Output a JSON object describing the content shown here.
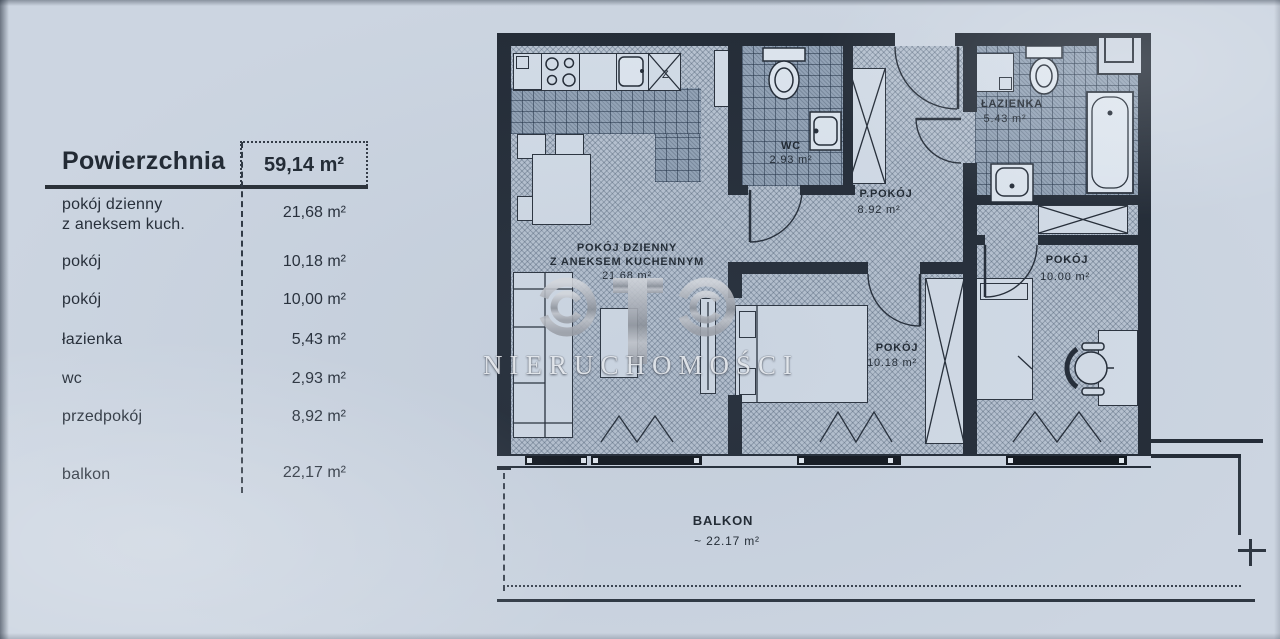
{
  "area_table": {
    "header_label": "Powierzchnia",
    "header_value": "59,14 m²",
    "rows": [
      {
        "label": "pokój dzienny",
        "label2": "z aneksem kuch.",
        "value": "21,68 m²"
      },
      {
        "label": "pokój",
        "label2": "",
        "value": "10,18 m²"
      },
      {
        "label": "pokój",
        "label2": "",
        "value": "10,00 m²"
      },
      {
        "label": "łazienka",
        "label2": "",
        "value": "5,43 m²"
      },
      {
        "label": "wc",
        "label2": "",
        "value": "2,93 m²"
      },
      {
        "label": "przedpokój",
        "label2": "",
        "value": "8,92 m²"
      },
      {
        "label": "balkon",
        "label2": "",
        "value": "22,17 m²"
      }
    ]
  },
  "floor_plan": {
    "living_room": {
      "name": "POKÓJ DZIENNY",
      "name2": "Z ANEKSEM KUCHENNYM",
      "area": "21.68 m²"
    },
    "wc": {
      "name": "WC",
      "area": "2.93 m²"
    },
    "hall": {
      "name": "P.POKÓJ",
      "area": "8.92 m²"
    },
    "bathroom": {
      "name": "ŁAZIENKA",
      "area": "5.43 m²"
    },
    "bedroom": {
      "name": "POKÓJ",
      "area": "10.18 m²"
    },
    "room2": {
      "name": "POKÓJ",
      "area": "10.00 m²"
    },
    "balcony": {
      "name": "BALKON",
      "area": "~ 22.17 m²"
    },
    "dishwasher_symbol": "Z"
  },
  "watermark": {
    "logo": "OTO",
    "brand": "NIERUCHOMOŚCI"
  },
  "colors": {
    "paper": "#ccd5e1",
    "ink": "#242c37",
    "floor_hatch": "#b7c2d0",
    "tile": "#93a3b6",
    "window_glass": "#12171e",
    "watermark_silver": "#a8acb3"
  }
}
